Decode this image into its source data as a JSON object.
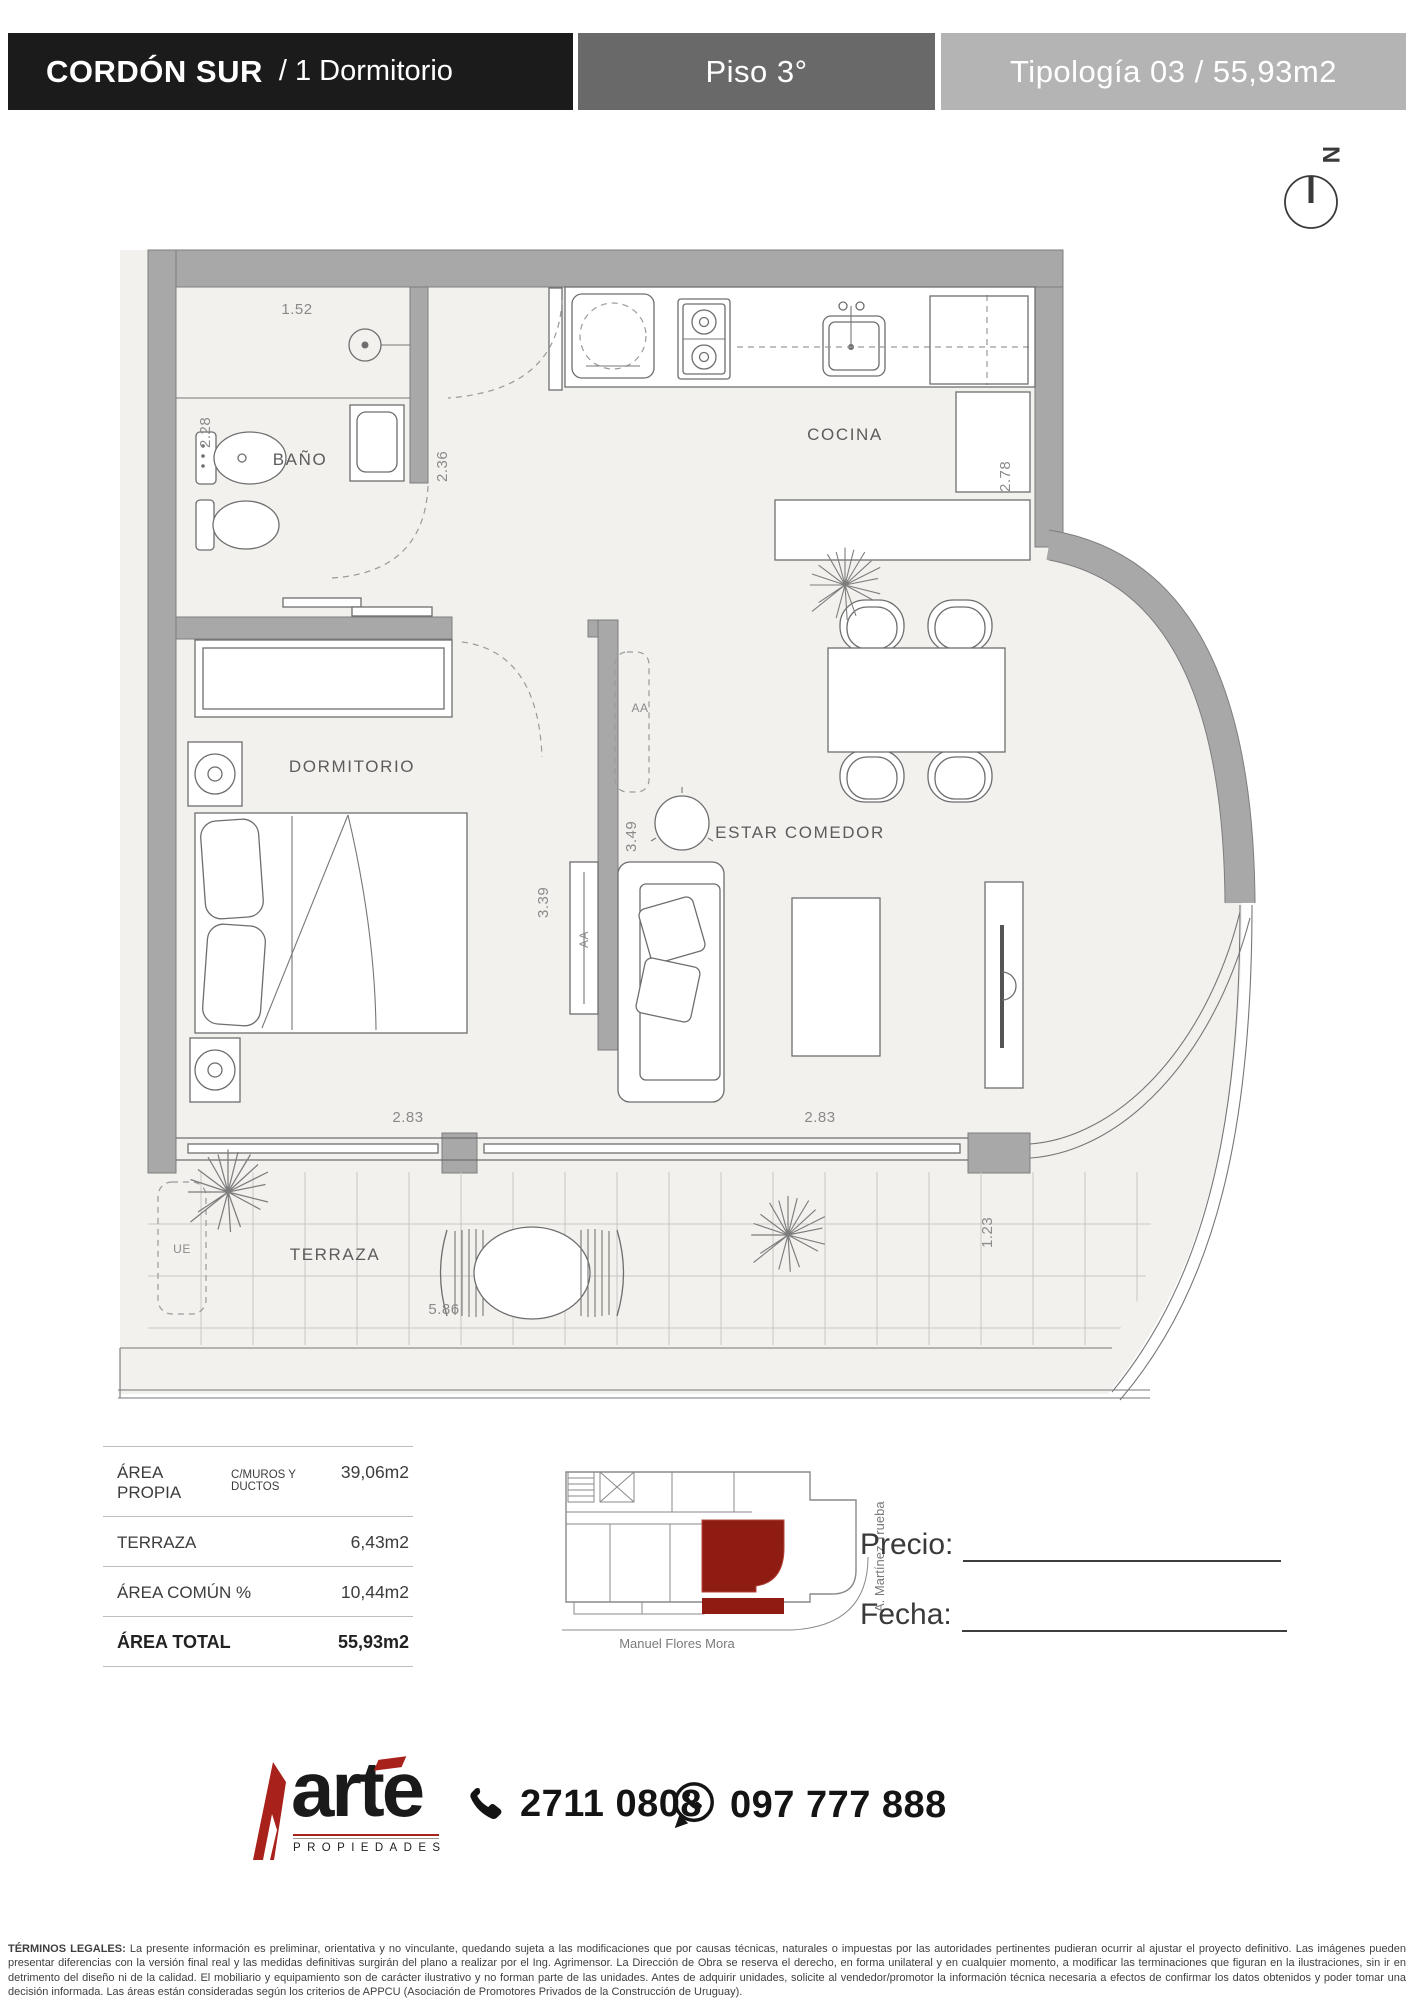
{
  "header": {
    "project": "CORDÓN SUR",
    "unit": "/ 1 Dormitorio",
    "floor": "Piso 3°",
    "typology": "Tipología 03 / 55,93m2"
  },
  "north_label": "N",
  "plan": {
    "labels": {
      "bano": "BAÑO",
      "cocina": "COCINA",
      "dormitorio": "DORMITORIO",
      "estar": "ESTAR COMEDOR",
      "terraza": "TERRAZA",
      "ue": "UE",
      "aa_living": "AA",
      "aa_dorm": "AA"
    },
    "dims": {
      "w_bano": "1.52",
      "h_bano": "2.28",
      "h_hall": "2.36",
      "h_cocina": "2.78",
      "h_estar": "3.49",
      "h_dorm": "3.39",
      "w_dorm": "2.83",
      "w_estar": "2.83",
      "w_terraza": "5.86",
      "h_terraza": "1.23"
    }
  },
  "areas": {
    "rows": [
      {
        "label": "ÁREA PROPIA",
        "sublabel": "C/MUROS Y DUCTOS",
        "value": "39,06m2"
      },
      {
        "label": "TERRAZA",
        "sublabel": "",
        "value": "6,43m2"
      },
      {
        "label": "ÁREA COMÚN %",
        "sublabel": "",
        "value": "10,44m2"
      }
    ],
    "total_label": "ÁREA TOTAL",
    "total_value": "55,93m2"
  },
  "map": {
    "street_bottom": "Manuel Flores Mora",
    "street_right": "A. Martínez Trueba",
    "highlight_color": "#8e1c12"
  },
  "form": {
    "price": "Precio:",
    "date": "Fecha:"
  },
  "footer": {
    "brand": "arte",
    "brand_sub": "PROPIEDADES",
    "phone": "2711 0808",
    "whatsapp": "097 777 888"
  },
  "legal": {
    "title": "TÉRMINOS LEGALES:",
    "body": " La presente información es preliminar, orientativa y no vinculante, quedando sujeta a las modificaciones que por causas técnicas, naturales o impuestas por las autoridades pertinentes pudieran ocurrir al ajustar el proyecto definitivo. Las imágenes pueden presentar diferencias con la versión final real y las medidas definitivas surgirán del plano a realizar por el Ing. Agrimensor. La Dirección de Obra se reserva el derecho, en forma unilateral y en cualquier momento, a modificar las terminaciones que figuran en la ilustraciones, sin ir en detrimento del diseño ni de la calidad. El mobiliario y equipamiento son de carácter ilustrativo y no forman parte de las unidades. Antes de adquirir unidades, solicite al vendedor/promotor la información técnica necesaria a efectos de confirmar los datos obtenidos y poder tomar una decisión informada. Las áreas están consideradas según los criterios de APPCU (Asociación de Promotores Privados de la Construcción de Uruguay)."
  }
}
